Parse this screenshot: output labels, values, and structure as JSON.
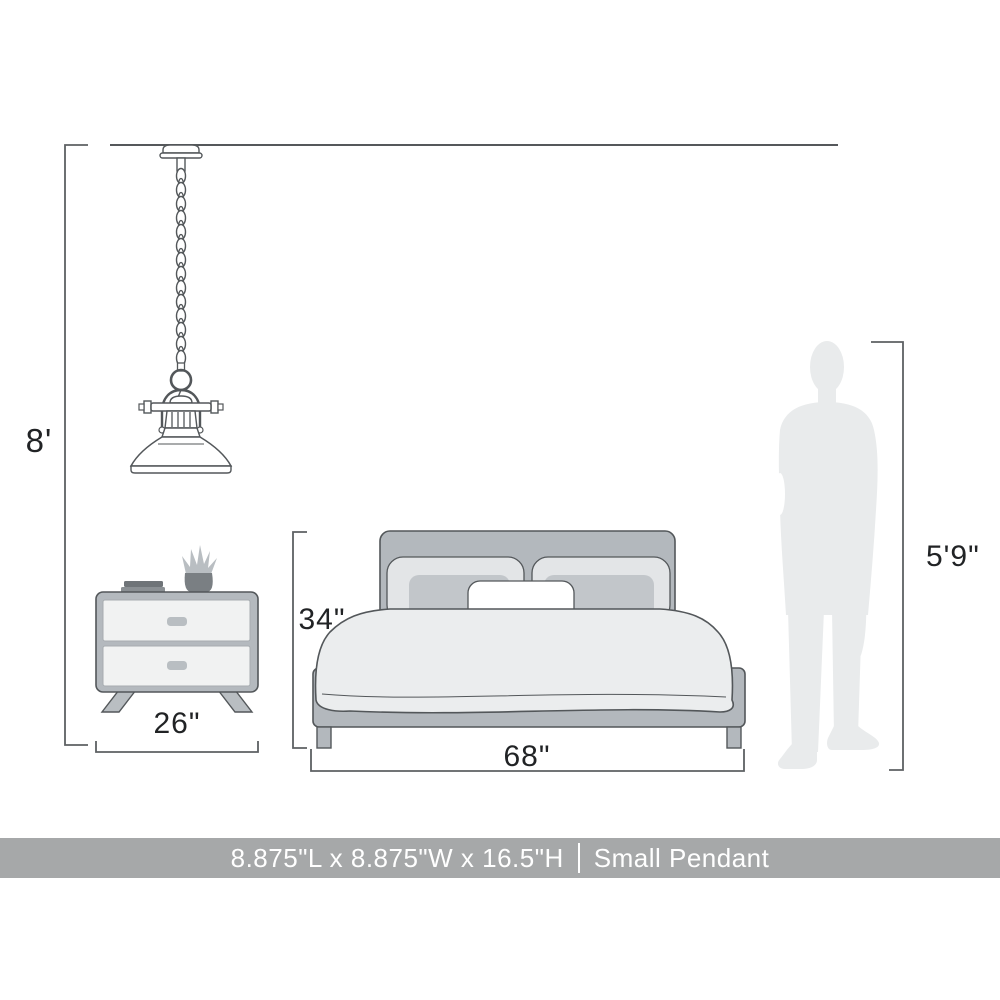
{
  "banner": {
    "dimensions": "8.875\"L x 8.875\"W x 16.5\"H",
    "separator": "|",
    "product_name": "Small Pendant",
    "background_color": "#a6a8a9",
    "text_color": "#ffffff"
  },
  "measurements": {
    "ceiling_height": "8'",
    "nightstand_width": "26\"",
    "bed_height": "34\"",
    "bed_width": "68\"",
    "person_height": "5'9\""
  },
  "illustrations": {
    "pendant_light": "pendant-light-line-art",
    "nightstand": "two-drawer-nightstand",
    "bed": "upholstered-bed-front-view",
    "person": "male-silhouette"
  },
  "colors": {
    "furniture_gray": "#b3b8bd",
    "light_fill": "#ebedee",
    "drawer_fill": "#f1f2f2",
    "accent_pillow": "#c2c6ca",
    "back_pillow": "#e3e5e7",
    "silhouette": "#e9ebec",
    "line": "#55585b",
    "text": "#212325",
    "banner_background": "#a6a8a9",
    "banner_text": "#ffffff"
  }
}
